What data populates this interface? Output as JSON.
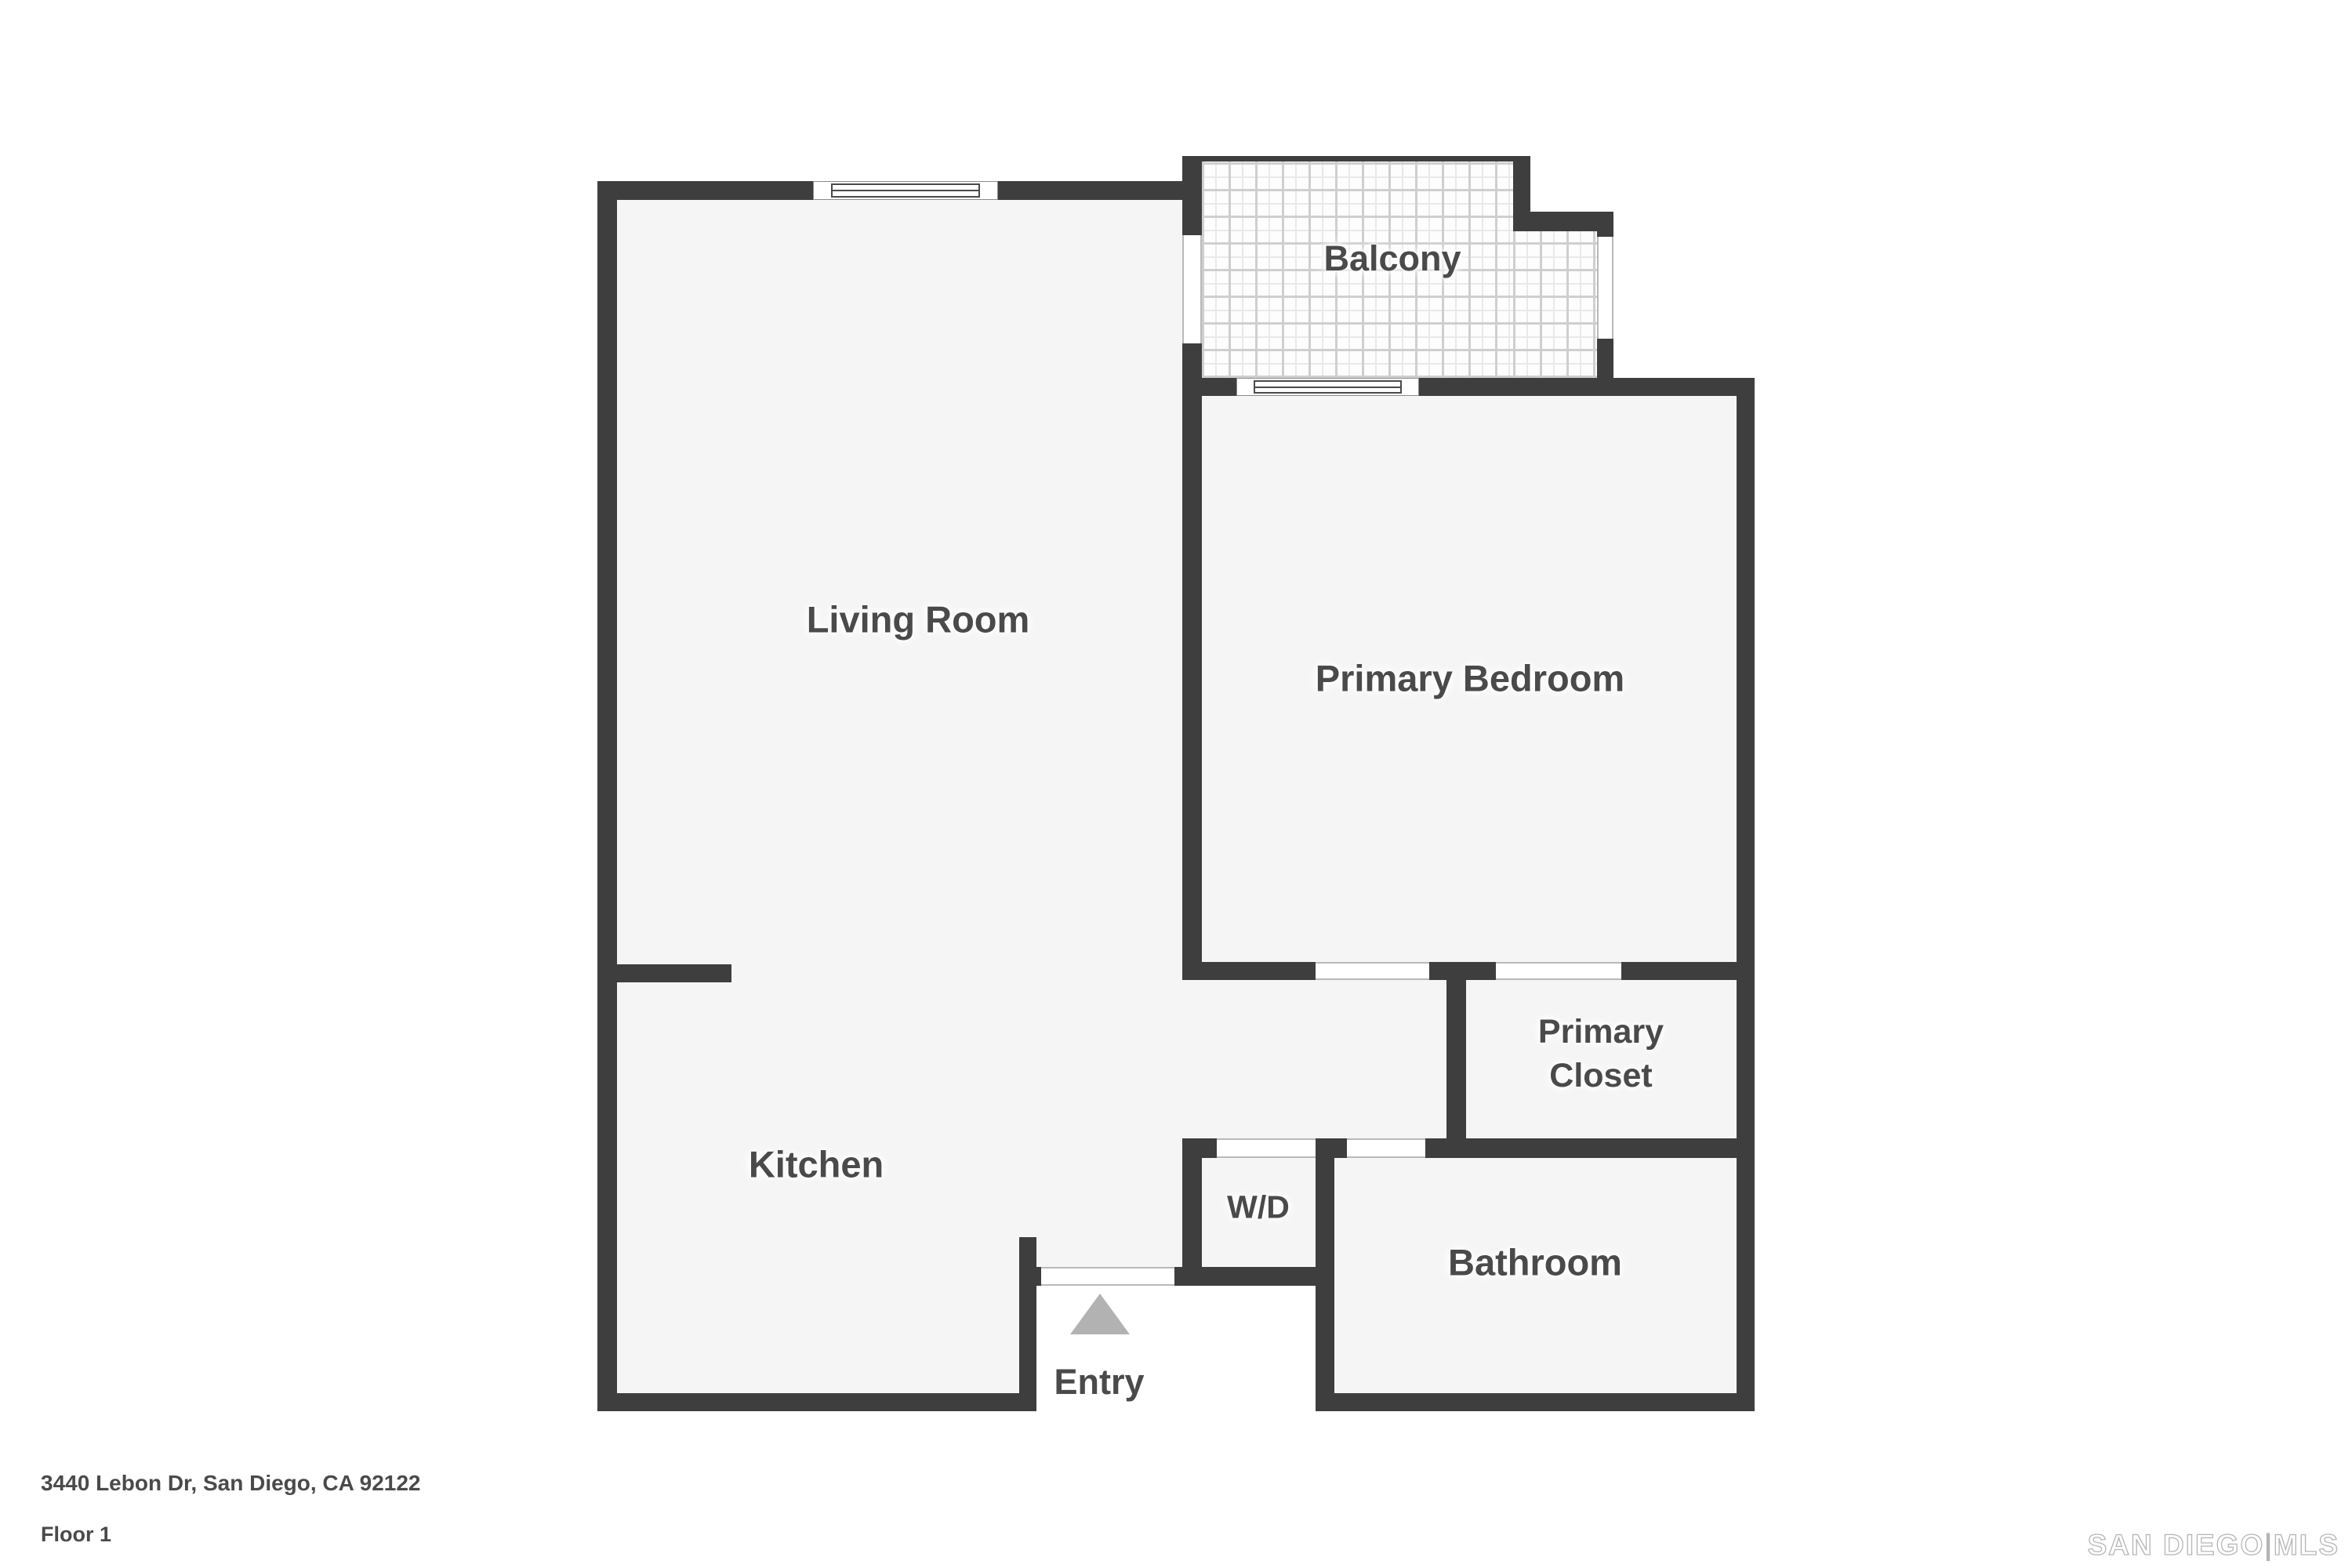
{
  "floorplan": {
    "rooms": {
      "living_room": "Living Room",
      "balcony": "Balcony",
      "primary_bedroom": "Primary Bedroom",
      "kitchen": "Kitchen",
      "primary_closet_line1": "Primary",
      "primary_closet_line2": "Closet",
      "washer_dryer": "W/D",
      "bathroom": "Bathroom",
      "entry": "Entry"
    },
    "colors": {
      "wall": "#3e3e3e",
      "floor": "#f5f5f5",
      "outside": "#ffffff",
      "tile_line": "#cfcfcf",
      "label_text": "#4a4a4a",
      "entry_arrow": "#b2b2b2",
      "watermark": "#b5b5b5"
    }
  },
  "footer": {
    "address": "3440 Lebon Dr, San Diego, CA 92122",
    "floor": "Floor 1"
  },
  "watermark": {
    "brand": "SAN DIEGO",
    "separator": "|",
    "suffix": "MLS"
  }
}
